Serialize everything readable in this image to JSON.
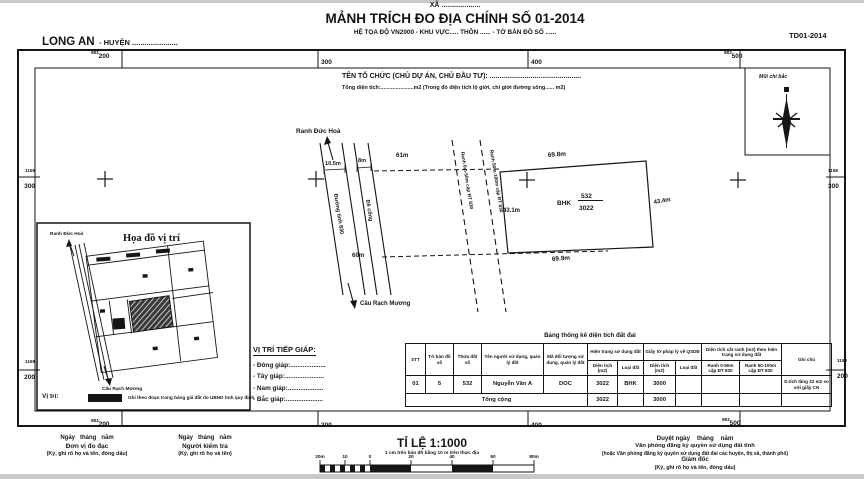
{
  "header": {
    "commune": "XÃ ....................",
    "title": "MẢNH TRÍCH ĐO ĐỊA CHÍNH SỐ 01-2014",
    "subtitle": "HỆ TỌA ĐỘ VN2000 - KHU VỰC..... THÔN ...... - TỜ BẢN ĐỒ SỐ ......",
    "province": "LONG AN",
    "province_suffix": "- HUYỆN ......................",
    "sheet_code": "TD01-2014"
  },
  "org": {
    "line1": "TÊN TỔ CHỨC (CHỦ DỰ ÁN, CHỦ ĐẦU TƯ): ...............................................",
    "line2": "Tổng diện tích:......................m2 (Trong đó diện tích lộ giới, chỉ giới đường sông...... m2)"
  },
  "compass": {
    "label": "Mũi chỉ bắc"
  },
  "grid": {
    "top": [
      {
        "sup": "983",
        "val": "200"
      },
      {
        "val": "300"
      },
      {
        "val": "400"
      },
      {
        "sup": "983",
        "val": "500"
      }
    ],
    "bottom": [
      {
        "sup": "983",
        "val": "200"
      },
      {
        "val": "300"
      },
      {
        "val": "400"
      },
      {
        "sup": "983",
        "val": "500"
      }
    ],
    "left": [
      {
        "sup": "1158",
        "val": "300"
      },
      {
        "sup": "1158",
        "val": "200"
      }
    ],
    "right": [
      {
        "sup": "1158",
        "val": "300"
      },
      {
        "sup": "1158",
        "val": "200"
      }
    ]
  },
  "map": {
    "ranh_duc_hoa": "Ranh Đức Hoà",
    "cau_rach_muong": "Cầu Rạch Mương",
    "road1": "Đường tỉnh 830",
    "road2": "Đê cống",
    "ranh_0_50": "Ranh 0m-50m cặp ĐT 830",
    "ranh_50_100": "Ranh 50m-100m cặp ĐT 830",
    "dim_road1": "10.5m",
    "dim_road2": "8m",
    "dim_61": "61m",
    "dim_60": "60m",
    "parcel": {
      "top": "69.8m",
      "bottom": "69.9m",
      "left": "43.1m",
      "right": "43.4m",
      "type": "BHK",
      "num": "532",
      "area": "3022"
    }
  },
  "inset": {
    "title": "Họa đồ vị trí",
    "ranh_duc_hoa": "Ranh Đức Hoà",
    "cau_rach_muong": "Cầu Rạch Mương",
    "legend_label": "Vị trí:",
    "legend_note": "Ghi theo đoạn trong bảng giá đất do UBND tỉnh quy định"
  },
  "adjacency": {
    "title": "VỊ TRÍ TIẾP GIÁP:",
    "items": [
      "- Đông giáp:....................",
      "- Tây giáp:......................",
      "- Nam giáp:....................",
      "- Bắc giáp:....................."
    ]
  },
  "stats_table": {
    "title": "Bảng thống kê diện tích đất đai",
    "h": {
      "stt": "STT",
      "to_ban_do": "Tờ bản đồ số",
      "thua_dat": "Thửa đất số",
      "ten": "Tên người sử dụng, quản lý đất",
      "ma": "Mã đối tượng sử dụng, quản lý đất",
      "hien_trang": "Hiện trạng sử dụng đất",
      "giay_to": "Giấy tờ pháp lý về QSDĐ",
      "cat_ranh": "Diện tích cắt ranh (m2) theo hiện trạng sử dụng đất",
      "dien_tich": "Diện tích (m2)",
      "loai_dat": "Loại đất",
      "ranh1": "Ranh 0-50m cặp ĐT 830",
      "ranh2": "Ranh 50-100m cặp ĐT 830",
      "ghi_chu": "Ghi chú"
    },
    "row": [
      "01",
      "5",
      "532",
      "Nguyễn Văn A",
      "DOC",
      "3022",
      "BHK",
      "3000",
      "",
      "",
      "",
      "D.tích tăng 22 m2 so với giấy CN"
    ],
    "total_label": "Tổng cộng",
    "total": [
      "3022",
      "",
      "3000",
      "",
      "",
      "",
      ""
    ]
  },
  "scale": {
    "title": "TỈ LỆ 1:1000",
    "note": "1 cm trên bản đồ bằng 10 m trên thực địa",
    "ticks": [
      "20m",
      "10",
      "0",
      "20",
      "40",
      "60",
      "80m"
    ]
  },
  "signatures": {
    "left1": [
      "Ngày   tháng   năm",
      "Đơn vị đo đạc",
      "(Ký, ghi rõ họ và tên, đóng dấu)"
    ],
    "left2": [
      "Ngày   tháng   năm",
      "Người kiểm tra",
      "(Ký, ghi rõ họ và tên)"
    ],
    "right": [
      "Duyệt ngày    tháng    năm",
      "Văn phòng đăng ký quyền sử dụng đất tỉnh",
      "(hoặc Văn phòng đăng ký quyền sử dụng đất đai các huyện, thị xã, thành phố)",
      "Giám đốc",
      "(Ký, ghi rõ họ và tên, đóng dấu)"
    ]
  }
}
